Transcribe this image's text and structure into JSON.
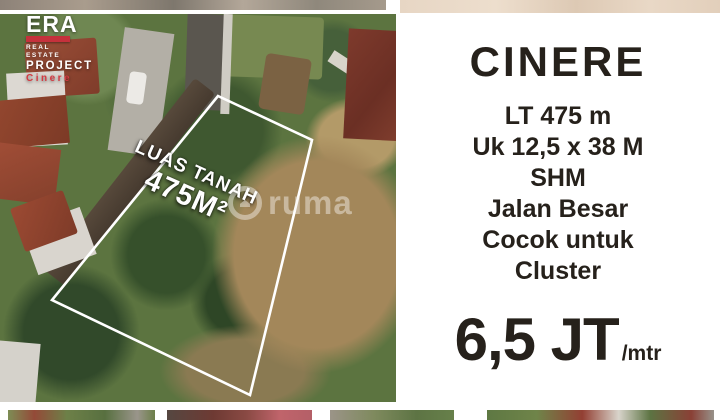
{
  "brand_logo": {
    "name": "ERA",
    "tagline": "REAL ESTATE",
    "line_project": "PROJECT",
    "line_location": "Cinere"
  },
  "aerial_photo": {
    "plot_label_title": "LUAS TANAH",
    "plot_label_area": "475M²",
    "watermark_text": "ruma"
  },
  "listing_panel": {
    "title": "CINERE",
    "details": [
      "LT 475 m",
      "Uk 12,5 x 38 M",
      "SHM",
      "Jalan Besar",
      "Cocok untuk",
      "Cluster"
    ],
    "price_value": "6,5 JT",
    "price_unit": "/mtr"
  },
  "colors": {
    "brand_red": "#c5313c",
    "text_dark": "#26211b",
    "panel_bg": "#ffffff",
    "plot_outline": "#ffffff"
  }
}
